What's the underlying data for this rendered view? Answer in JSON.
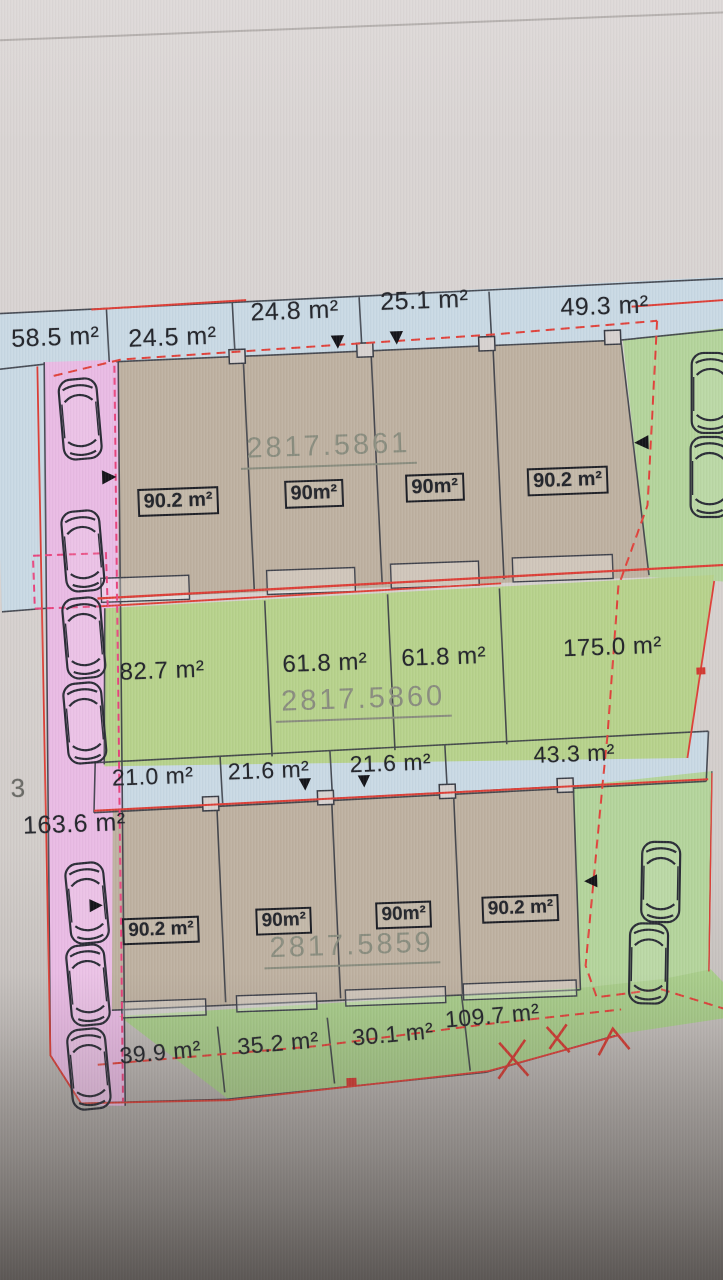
{
  "parcels": {
    "upper": {
      "number": "2817.5861",
      "front_areas": [
        "58.5 m²",
        "24.5 m²",
        "24.8 m²",
        "25.1 m²",
        "49.3 m²"
      ],
      "plot_areas": [
        "90.2 m²",
        "90m²",
        "90m²",
        "90.2 m²"
      ]
    },
    "middle": {
      "number": "2817.5860",
      "plot_areas": [
        "82.7 m²",
        "61.8 m²",
        "61.8 m²",
        "175.0 m²"
      ],
      "front_areas": [
        "21.0 m²",
        "21.6 m²",
        "21.6 m²",
        "43.3 m²"
      ]
    },
    "lower": {
      "number": "2817.5859",
      "plot_areas": [
        "90.2 m²",
        "90m²",
        "90m²",
        "90.2 m²"
      ],
      "rear_areas": [
        "39.9 m²",
        "35.2 m²",
        "30.1 m²",
        "109.7 m²"
      ]
    }
  },
  "side_labels": {
    "left_area": "163.6 m²",
    "left_partial_digit": "3"
  },
  "icons": {
    "down_triangle": "▼",
    "right_triangle": "►",
    "left_triangle": "◄",
    "car": "car-top-view",
    "boundary_cross": "×"
  },
  "colors": {
    "front_strip_blue": "#c9d9e4",
    "house_plot_tan": "#beb1a1",
    "parking_lane_pink": "#e9bbe4",
    "garden_green_mid": "#b7d28c",
    "garden_green_side": "#b4d49c",
    "garden_green_rear": "#a9cd8b",
    "boundary_red": "#dd4038",
    "boundary_pink_dash": "#e8457e",
    "line_dark": "#3a3d46",
    "parcel_number_text": "#8a8d7f",
    "label_text": "#24262c"
  }
}
